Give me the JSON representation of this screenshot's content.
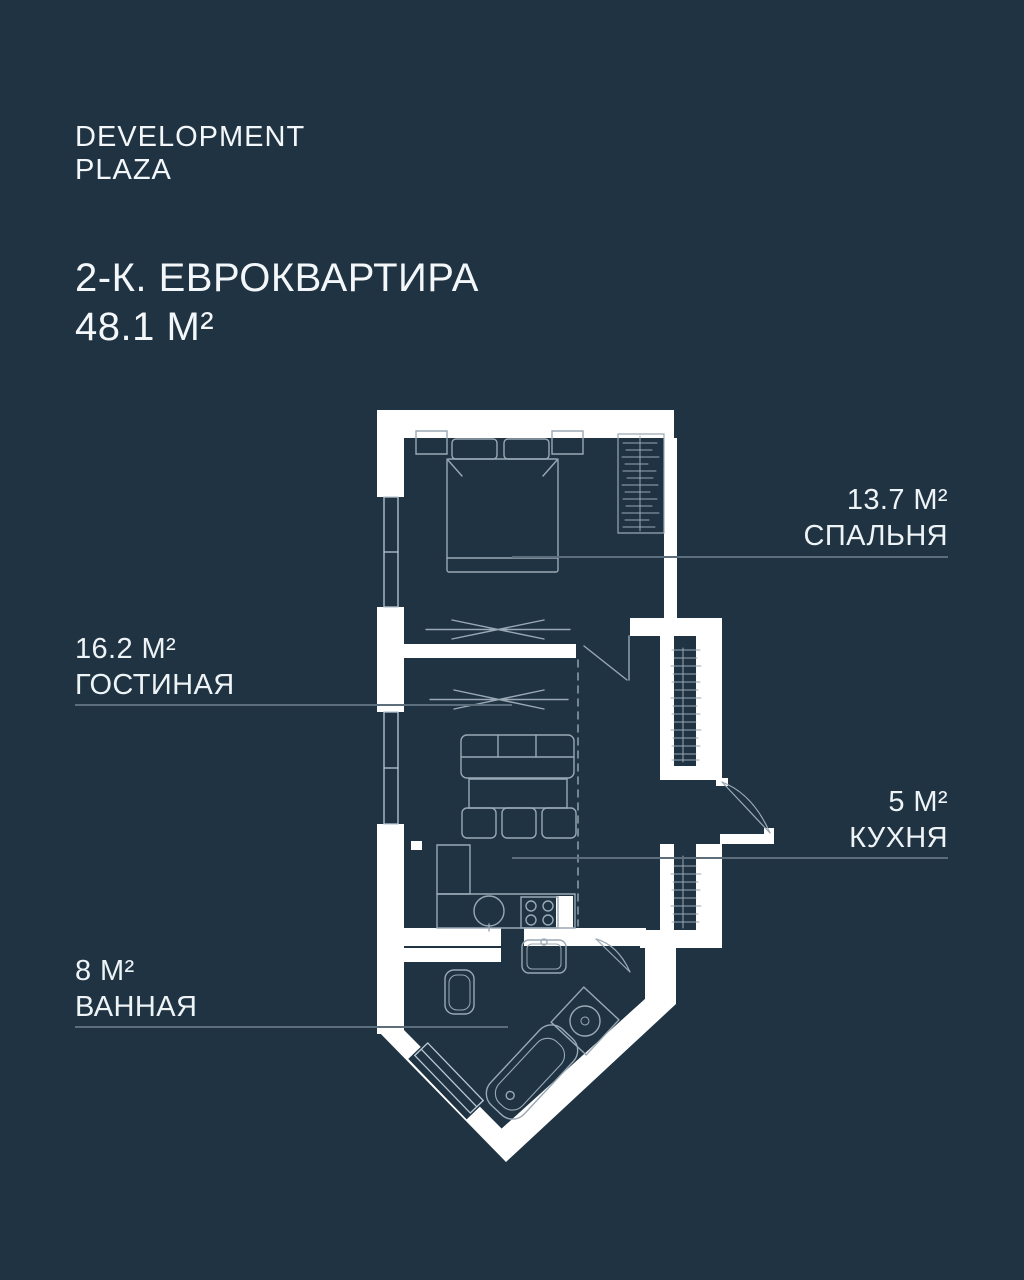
{
  "theme": {
    "background": "#1f3343",
    "text_color": "#f2f6f8",
    "wall_color": "#ffffff",
    "furniture_line_color": "#9aa9b5",
    "window_line_color": "#bcc9d4",
    "leader_line_color": "#5c6d7b"
  },
  "brand": {
    "line1": "DEVELOPMENT",
    "line2": "PLAZA"
  },
  "listing": {
    "type_line": "2-К. ЕВРОКВАРТИРА",
    "area_line": "48.1 М²"
  },
  "rooms": [
    {
      "id": "bedroom",
      "area": "13.7 М²",
      "name": "СПАЛЬНЯ",
      "label_side": "right"
    },
    {
      "id": "living",
      "area": "16.2 М²",
      "name": "ГОСТИНАЯ",
      "label_side": "left"
    },
    {
      "id": "kitchen",
      "area": "5 М²",
      "name": "КУХНЯ",
      "label_side": "right"
    },
    {
      "id": "bathroom",
      "area": "8 М²",
      "name": "ВАННАЯ",
      "label_side": "left"
    }
  ]
}
